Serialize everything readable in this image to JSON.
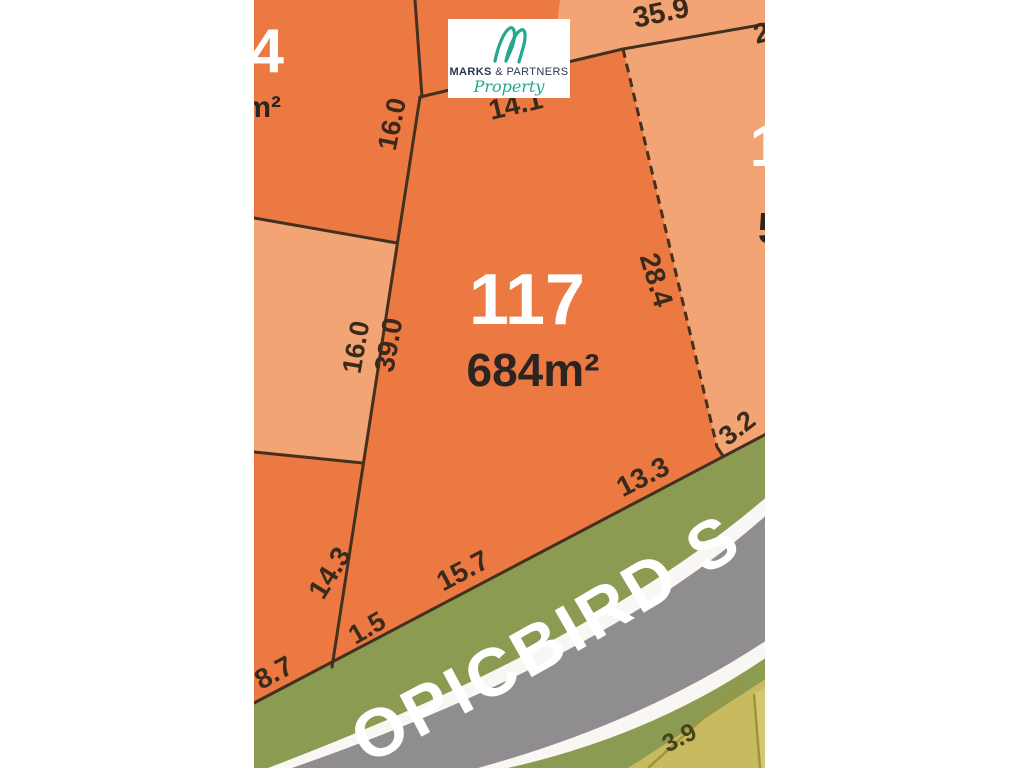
{
  "lot": {
    "number": "117",
    "area": "684m²"
  },
  "dims": {
    "top_right_outer": "35.9",
    "top_right_corner_partial": "2",
    "north": "14.1",
    "west_neighbor_top": "16.0",
    "west_neighbor_mid": "16.0",
    "west": "39.0",
    "east": "28.4",
    "southeast_short": "3.2",
    "south_right": "13.3",
    "south_mid": "15.7",
    "southwest_neighbor": "14.3",
    "southwest_short": "1.5",
    "southwest_neighbor_frontage": "8.7",
    "far_lot_south": "3.9"
  },
  "neighbors": {
    "northwest_lot_number_partial": "4",
    "northwest_lot_area_partial": "m²",
    "east_lot_number_partial": "1",
    "east_lot_area_partial": "5"
  },
  "street": {
    "visible_text": "OPICBIRD S"
  },
  "logo": {
    "monogram": "M",
    "name_bold": "MARKS",
    "name_rest": " & PARTNERS",
    "tagline": "Property"
  },
  "colors": {
    "lot_dark_orange": "#ED7942",
    "lot_light_orange": "#F3A474",
    "boundary_line": "#43301E",
    "verge_green": "#8B9B51",
    "road_gray": "#8F8D90",
    "road_stripe_white": "#F8F7F3",
    "khaki_lot": "#C8BA5E",
    "khaki_lot_light": "#D3C772",
    "dim_text": "#3A2A1C",
    "lot_number_text": "#FFFFFF",
    "area_text": "#2B2421",
    "logo_teal": "#23A78D",
    "logo_navy": "#2A3550",
    "background": "#FFFFFF"
  }
}
